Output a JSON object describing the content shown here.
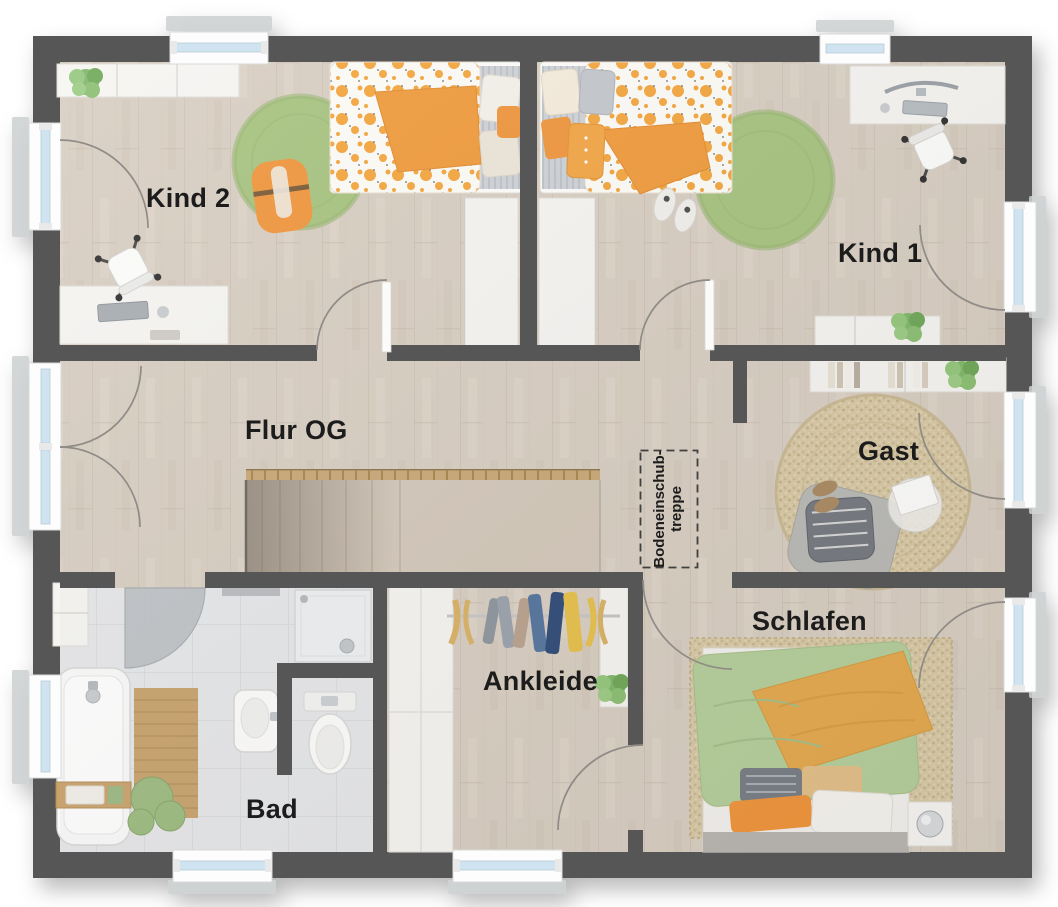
{
  "plan": {
    "title": "Obergeschoss Grundriss",
    "rooms": [
      {
        "id": "kind2",
        "label": "Kind 2"
      },
      {
        "id": "kind1",
        "label": "Kind 1"
      },
      {
        "id": "flur",
        "label": "Flur OG"
      },
      {
        "id": "gast",
        "label": "Gast"
      },
      {
        "id": "schlafen",
        "label": "Schlafen"
      },
      {
        "id": "ankleide",
        "label": "Ankleide"
      },
      {
        "id": "bad",
        "label": "Bad"
      }
    ],
    "attic_stairs_label": {
      "line1": "Bodeneinschub-",
      "line2": "treppe"
    }
  },
  "colors": {
    "wall": "#575756",
    "floor_wood": "#d8cec2",
    "floor_tile": "#e6e7e9",
    "rug_green": "#a6c37f",
    "rug_jute": "#d8c9a5",
    "accent_orange": "#f0953b",
    "bed_green": "#b5cf9b",
    "blanket_orange": "#e5a94f",
    "window_glass": "#cfe4f0",
    "stair_rail": "#c9a877",
    "label_text": "#1b1b1b"
  }
}
